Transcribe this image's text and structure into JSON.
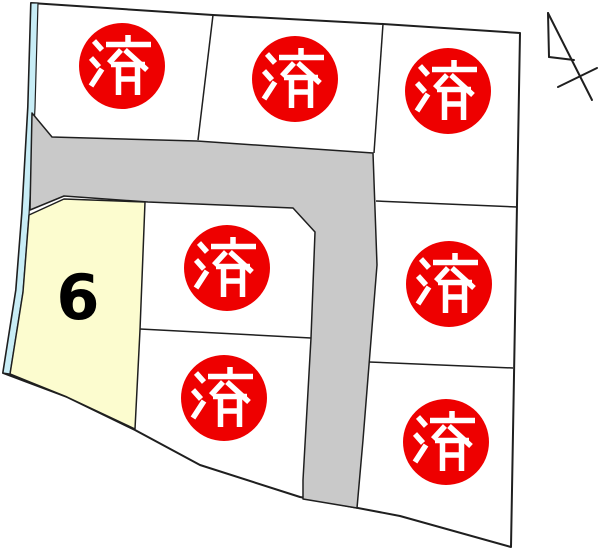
{
  "map": {
    "background": "#FFFFFF",
    "outline_color": "#1F1F1F",
    "sold_stamp": {
      "label": "済",
      "fill": "#EE0000",
      "text_color": "#FFFFFF",
      "count": 7
    },
    "available_lot": {
      "number": "6",
      "fill": "#FCFCCF",
      "text_color": "#000000"
    },
    "road": {
      "fill": "#C9C9C9"
    },
    "waterway": {
      "fill": "#C8EDF6"
    },
    "north_arrow_icon": "north-arrow",
    "lots": [
      {
        "id": "top-left",
        "status": "sold"
      },
      {
        "id": "top-middle",
        "status": "sold"
      },
      {
        "id": "top-right",
        "status": "sold"
      },
      {
        "id": "center-upper",
        "status": "sold"
      },
      {
        "id": "center-lower",
        "status": "sold"
      },
      {
        "id": "right-middle",
        "status": "sold"
      },
      {
        "id": "right-bottom",
        "status": "sold"
      },
      {
        "id": "lot-6",
        "status": "available",
        "number": "6"
      }
    ]
  }
}
